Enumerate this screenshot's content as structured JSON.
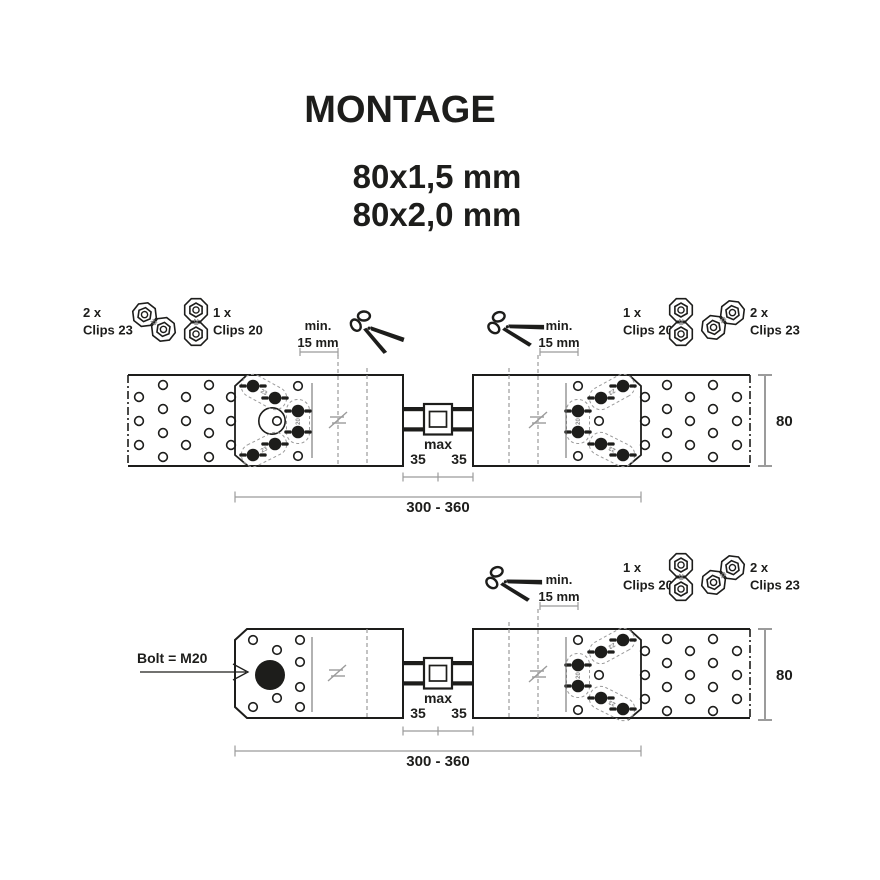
{
  "title": "MONTAGE",
  "size_line1": "80x1,5 mm",
  "size_line2": "80x2,0 mm",
  "legend": {
    "clips23_qty": "2 x",
    "clips23_label": "Clips 23",
    "clips20_qty": "1 x",
    "clips20_label": "Clips 20"
  },
  "labels": {
    "min1": "min.",
    "min2": "15 mm",
    "max": "max",
    "seg35": "35",
    "overall": "300 - 360",
    "width": "80",
    "bolt": "Bolt = M20",
    "tag20": "20",
    "tag23": "23"
  },
  "colors": {
    "ink": "#1d1d1b",
    "construction": "#9b9b9b",
    "zone_line": "#666666",
    "tag_gray": "#8a8a8a",
    "background": "#ffffff"
  }
}
